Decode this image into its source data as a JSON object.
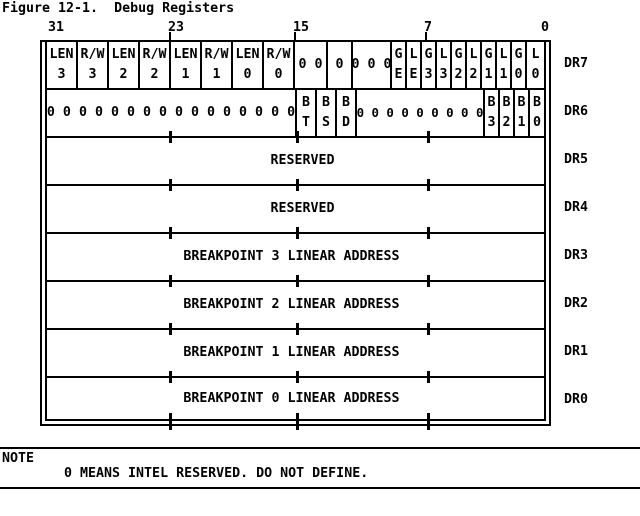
{
  "title": "Figure 12-1.  Debug Registers",
  "colors": {
    "foreground": "#000000",
    "background": "#ffffff"
  },
  "bit_scale": {
    "b31": "31",
    "b23": "23",
    "b15": "15",
    "b7": "7",
    "b0": "0"
  },
  "registers": [
    {
      "name": "DR7",
      "cells": [
        {
          "top": "LEN",
          "bottom": "3"
        },
        {
          "top": "R/W",
          "bottom": "3"
        },
        {
          "top": "LEN",
          "bottom": "2"
        },
        {
          "top": "R/W",
          "bottom": "2"
        },
        {
          "top": "LEN",
          "bottom": "1"
        },
        {
          "top": "R/W",
          "bottom": "1"
        },
        {
          "top": "LEN",
          "bottom": "0"
        },
        {
          "top": "R/W",
          "bottom": "0"
        },
        {
          "text": "0 0"
        },
        {
          "text": "0"
        },
        {
          "text": "0 0 0"
        },
        {
          "top": "G",
          "bottom": "E"
        },
        {
          "top": "L",
          "bottom": "E"
        },
        {
          "top": "G",
          "bottom": "3"
        },
        {
          "top": "L",
          "bottom": "3"
        },
        {
          "top": "G",
          "bottom": "2"
        },
        {
          "top": "L",
          "bottom": "2"
        },
        {
          "top": "G",
          "bottom": "1"
        },
        {
          "top": "L",
          "bottom": "1"
        },
        {
          "top": "G",
          "bottom": "0"
        },
        {
          "top": "L",
          "bottom": "0"
        }
      ]
    },
    {
      "name": "DR6",
      "cells": [
        {
          "text": "0 0 0 0 0 0 0 0 0 0 0 0 0 0 0 0"
        },
        {
          "top": "B",
          "bottom": "T"
        },
        {
          "top": "B",
          "bottom": "S"
        },
        {
          "top": "B",
          "bottom": "D"
        },
        {
          "text": "0 0 0 0 0 0 0 0 0"
        },
        {
          "top": "B",
          "bottom": "3"
        },
        {
          "top": "B",
          "bottom": "2"
        },
        {
          "top": "B",
          "bottom": "1"
        },
        {
          "top": "B",
          "bottom": "0"
        }
      ]
    },
    {
      "name": "DR5",
      "text": "RESERVED"
    },
    {
      "name": "DR4",
      "text": "RESERVED"
    },
    {
      "name": "DR3",
      "text": "BREAKPOINT 3 LINEAR ADDRESS"
    },
    {
      "name": "DR2",
      "text": "BREAKPOINT 2 LINEAR ADDRESS"
    },
    {
      "name": "DR1",
      "text": "BREAKPOINT 1 LINEAR ADDRESS"
    },
    {
      "name": "DR0",
      "text": "BREAKPOINT 0 LINEAR ADDRESS"
    }
  ],
  "note": {
    "label": "NOTE",
    "text": "0 MEANS INTEL RESERVED. DO NOT DEFINE."
  }
}
